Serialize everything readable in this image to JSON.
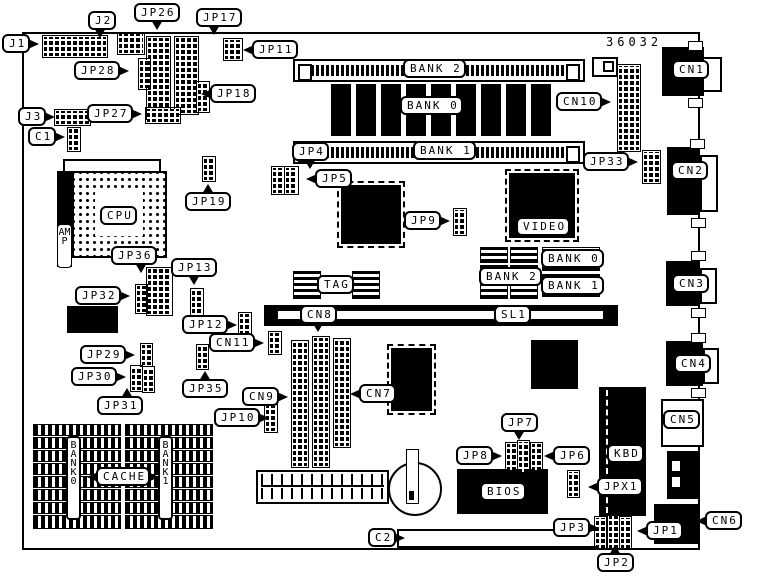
{
  "diagram": {
    "part_number": "36032",
    "ink_color": "#000000",
    "paper_color": "#ffffff",
    "description": "Motherboard jumper/connector location diagram"
  },
  "labels": {
    "j1": "J1",
    "j2": "J2",
    "j3": "J3",
    "jp1": "JP1",
    "jp2": "JP2",
    "jp3": "JP3",
    "jp4": "JP4",
    "jp5": "JP5",
    "jp6": "JP6",
    "jp7": "JP7",
    "jp8": "JP8",
    "jp9": "JP9",
    "jp10": "JP10",
    "jp11": "JP11",
    "jp12": "JP12",
    "jp13": "JP13",
    "jp17": "JP17",
    "jp18": "JP18",
    "jp19": "JP19",
    "jp26": "JP26",
    "jp27": "JP27",
    "jp28": "JP28",
    "jp29": "JP29",
    "jp30": "JP30",
    "jp31": "JP31",
    "jp32": "JP32",
    "jp33": "JP33",
    "jp35": "JP35",
    "jp36": "JP36",
    "jpx1": "JPX1",
    "c1": "C1",
    "c2": "C2",
    "cn1": "CN1",
    "cn2": "CN2",
    "cn3": "CN3",
    "cn4": "CN4",
    "cn5": "CN5",
    "cn6": "CN6",
    "cn7": "CN7",
    "cn8": "CN8",
    "cn9": "CN9",
    "cn10": "CN10",
    "cn11": "CN11",
    "sl1": "SL1",
    "cpu": "CPU",
    "amp": "AMP",
    "kbd": "KBD",
    "bios": "BIOS",
    "video": "VIDEO",
    "tag": "TAG",
    "cache": "CACHE",
    "bank0_dram": "BANK 0",
    "bank1_simm": "BANK 1",
    "bank2_simm": "BANK 2",
    "video_bank0": "BANK 0",
    "video_bank1": "BANK 1",
    "video_bank2": "BANK 2",
    "cache_bank0": "BANK 0",
    "cache_bank1": "BANK 1"
  }
}
